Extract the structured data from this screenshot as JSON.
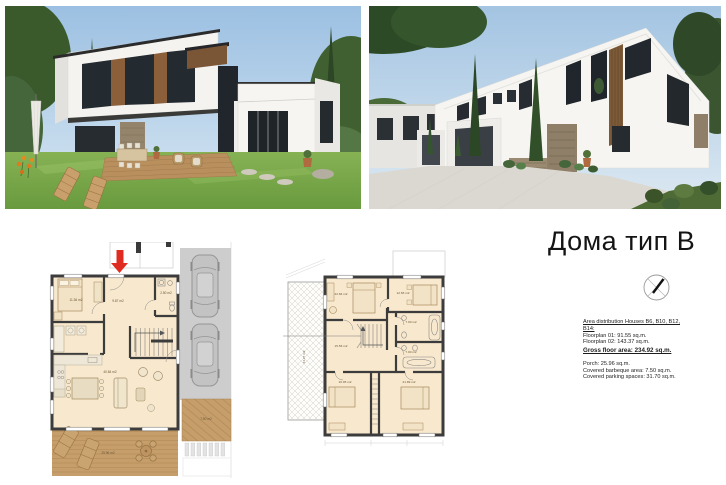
{
  "page": {
    "title": "Дома тип B"
  },
  "summary": {
    "heading_line1": "Area distribution Houses B6, B10, B12,",
    "heading_line2": "B14:",
    "floorplan_01": "Floorplan 01: 91.55 sq.m.",
    "floorplan_02": "Floorplan 02: 143.37 sq.m.",
    "gross_area": "Gross floor area: 234.92 sq.m.",
    "porch": "Porch: 25.96 sq.m.",
    "barbeque": "Covered barbeque area: 7.50 sq.m.",
    "parking": "Covered parking spaces: 31.70 sq.m."
  },
  "floorplan_ground": {
    "rooms": {
      "bedroom": "11.36 m2",
      "hall": "9.87 m2",
      "wc": "2.50 m2",
      "living_room": "40.84 m2",
      "porch": "25.96 m2",
      "barbeque_deck": "7.50 m2"
    }
  },
  "floorplan_upper": {
    "rooms": {
      "bedroom_top_left": "22.84 m2",
      "bedroom_top_right": "12.65 m2",
      "bathroom_1": "7.00 m2",
      "bathroom_2": "7.00 m2",
      "hall": "15.56 m2",
      "bedroom_bottom_left": "16.95 m2",
      "bedroom_bottom_right": "21.89 m2",
      "terrace": "24.27 m2"
    }
  },
  "icons": {
    "compass": "north-arrow-compass",
    "entrance_arrow": "red-entrance-arrow"
  },
  "colors": {
    "accent_red": "#e02b20",
    "plan_fill": "#f8e8cd",
    "wall_dark": "#3c3c3c",
    "wood_deck": "#c59e6b",
    "parking_gray": "#cdcdcd"
  }
}
